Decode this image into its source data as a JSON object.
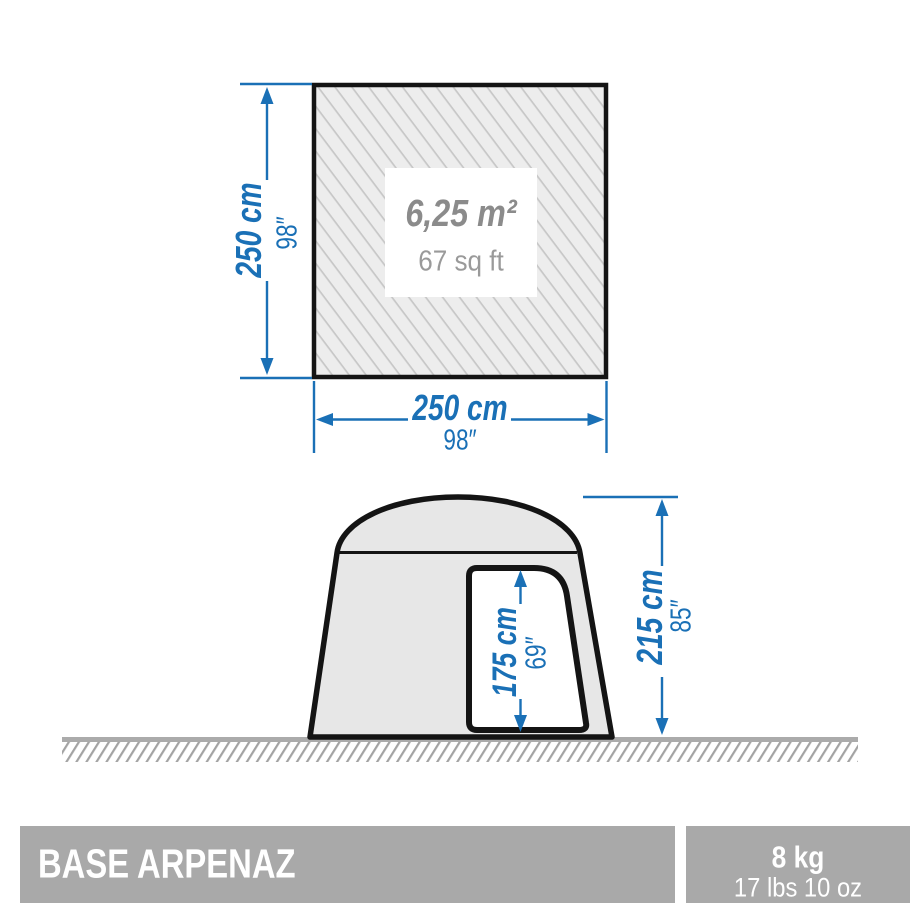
{
  "colors": {
    "dimension_blue": "#1a70b6",
    "outline_black": "#141414",
    "hatch_background": "#ededed",
    "hatch_line": "#c7c7c7",
    "tent_fill": "#e7e7e7",
    "ground_gray": "#ababab",
    "ground_hatch_line": "#a3a3a3",
    "area_text_gray": "#8b8b8b",
    "footer_bar_gray": "#a9a9a9",
    "footer_text_white": "#ffffff"
  },
  "top_view": {
    "area_metric": "6,25 m²",
    "area_imperial": "67 sq ft",
    "depth_metric": "250 cm",
    "depth_imperial": "98″",
    "width_metric": "250 cm",
    "width_imperial": "98″"
  },
  "side_view": {
    "door_height_metric": "175 cm",
    "door_height_imperial": "69″",
    "tent_height_metric": "215 cm",
    "tent_height_imperial": "85″"
  },
  "footer": {
    "product_name": "BASE ARPENAZ",
    "weight_metric": "8 kg",
    "weight_imperial": "17 lbs 10 oz"
  }
}
